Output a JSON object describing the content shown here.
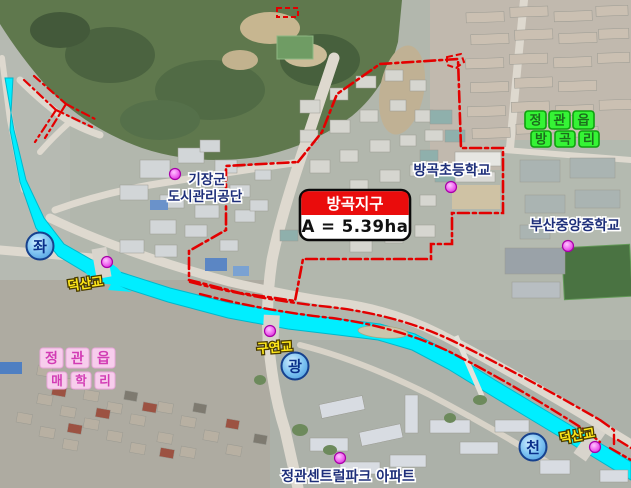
{
  "map": {
    "title_box": {
      "name": "방곡지구",
      "area": "A = 5.39ha"
    },
    "places": {
      "gijang_line1": "기장군",
      "gijang_line2": "도시관리공단",
      "banggok_elementary": "방곡초등학교",
      "busan_jungang_middle": "부산중앙중학교",
      "central_park_apt": "정관센트럴파크 아파트"
    },
    "bridges": {
      "deoksan_left": "덕산교",
      "guyeon": "구연교",
      "deoksan_right": "덕산교"
    },
    "road_badges": {
      "left": "좌",
      "center": "광",
      "right": "천"
    },
    "area_labels": {
      "banggok_ri": {
        "chars": [
          "정",
          "관",
          "읍",
          "방",
          "곡",
          "리"
        ]
      },
      "maehak_ri": {
        "chars": [
          "정",
          "관",
          "읍",
          "매",
          "학",
          "리"
        ]
      }
    },
    "colors": {
      "boundary_red": "#e30000",
      "river_cyan": "#00eeff",
      "title_red": "#ea0c0c",
      "banggok_ri_green": "#35f435",
      "maehak_ri_pink": "#f7cdec",
      "badge_blue": "#7fc4f2"
    }
  }
}
